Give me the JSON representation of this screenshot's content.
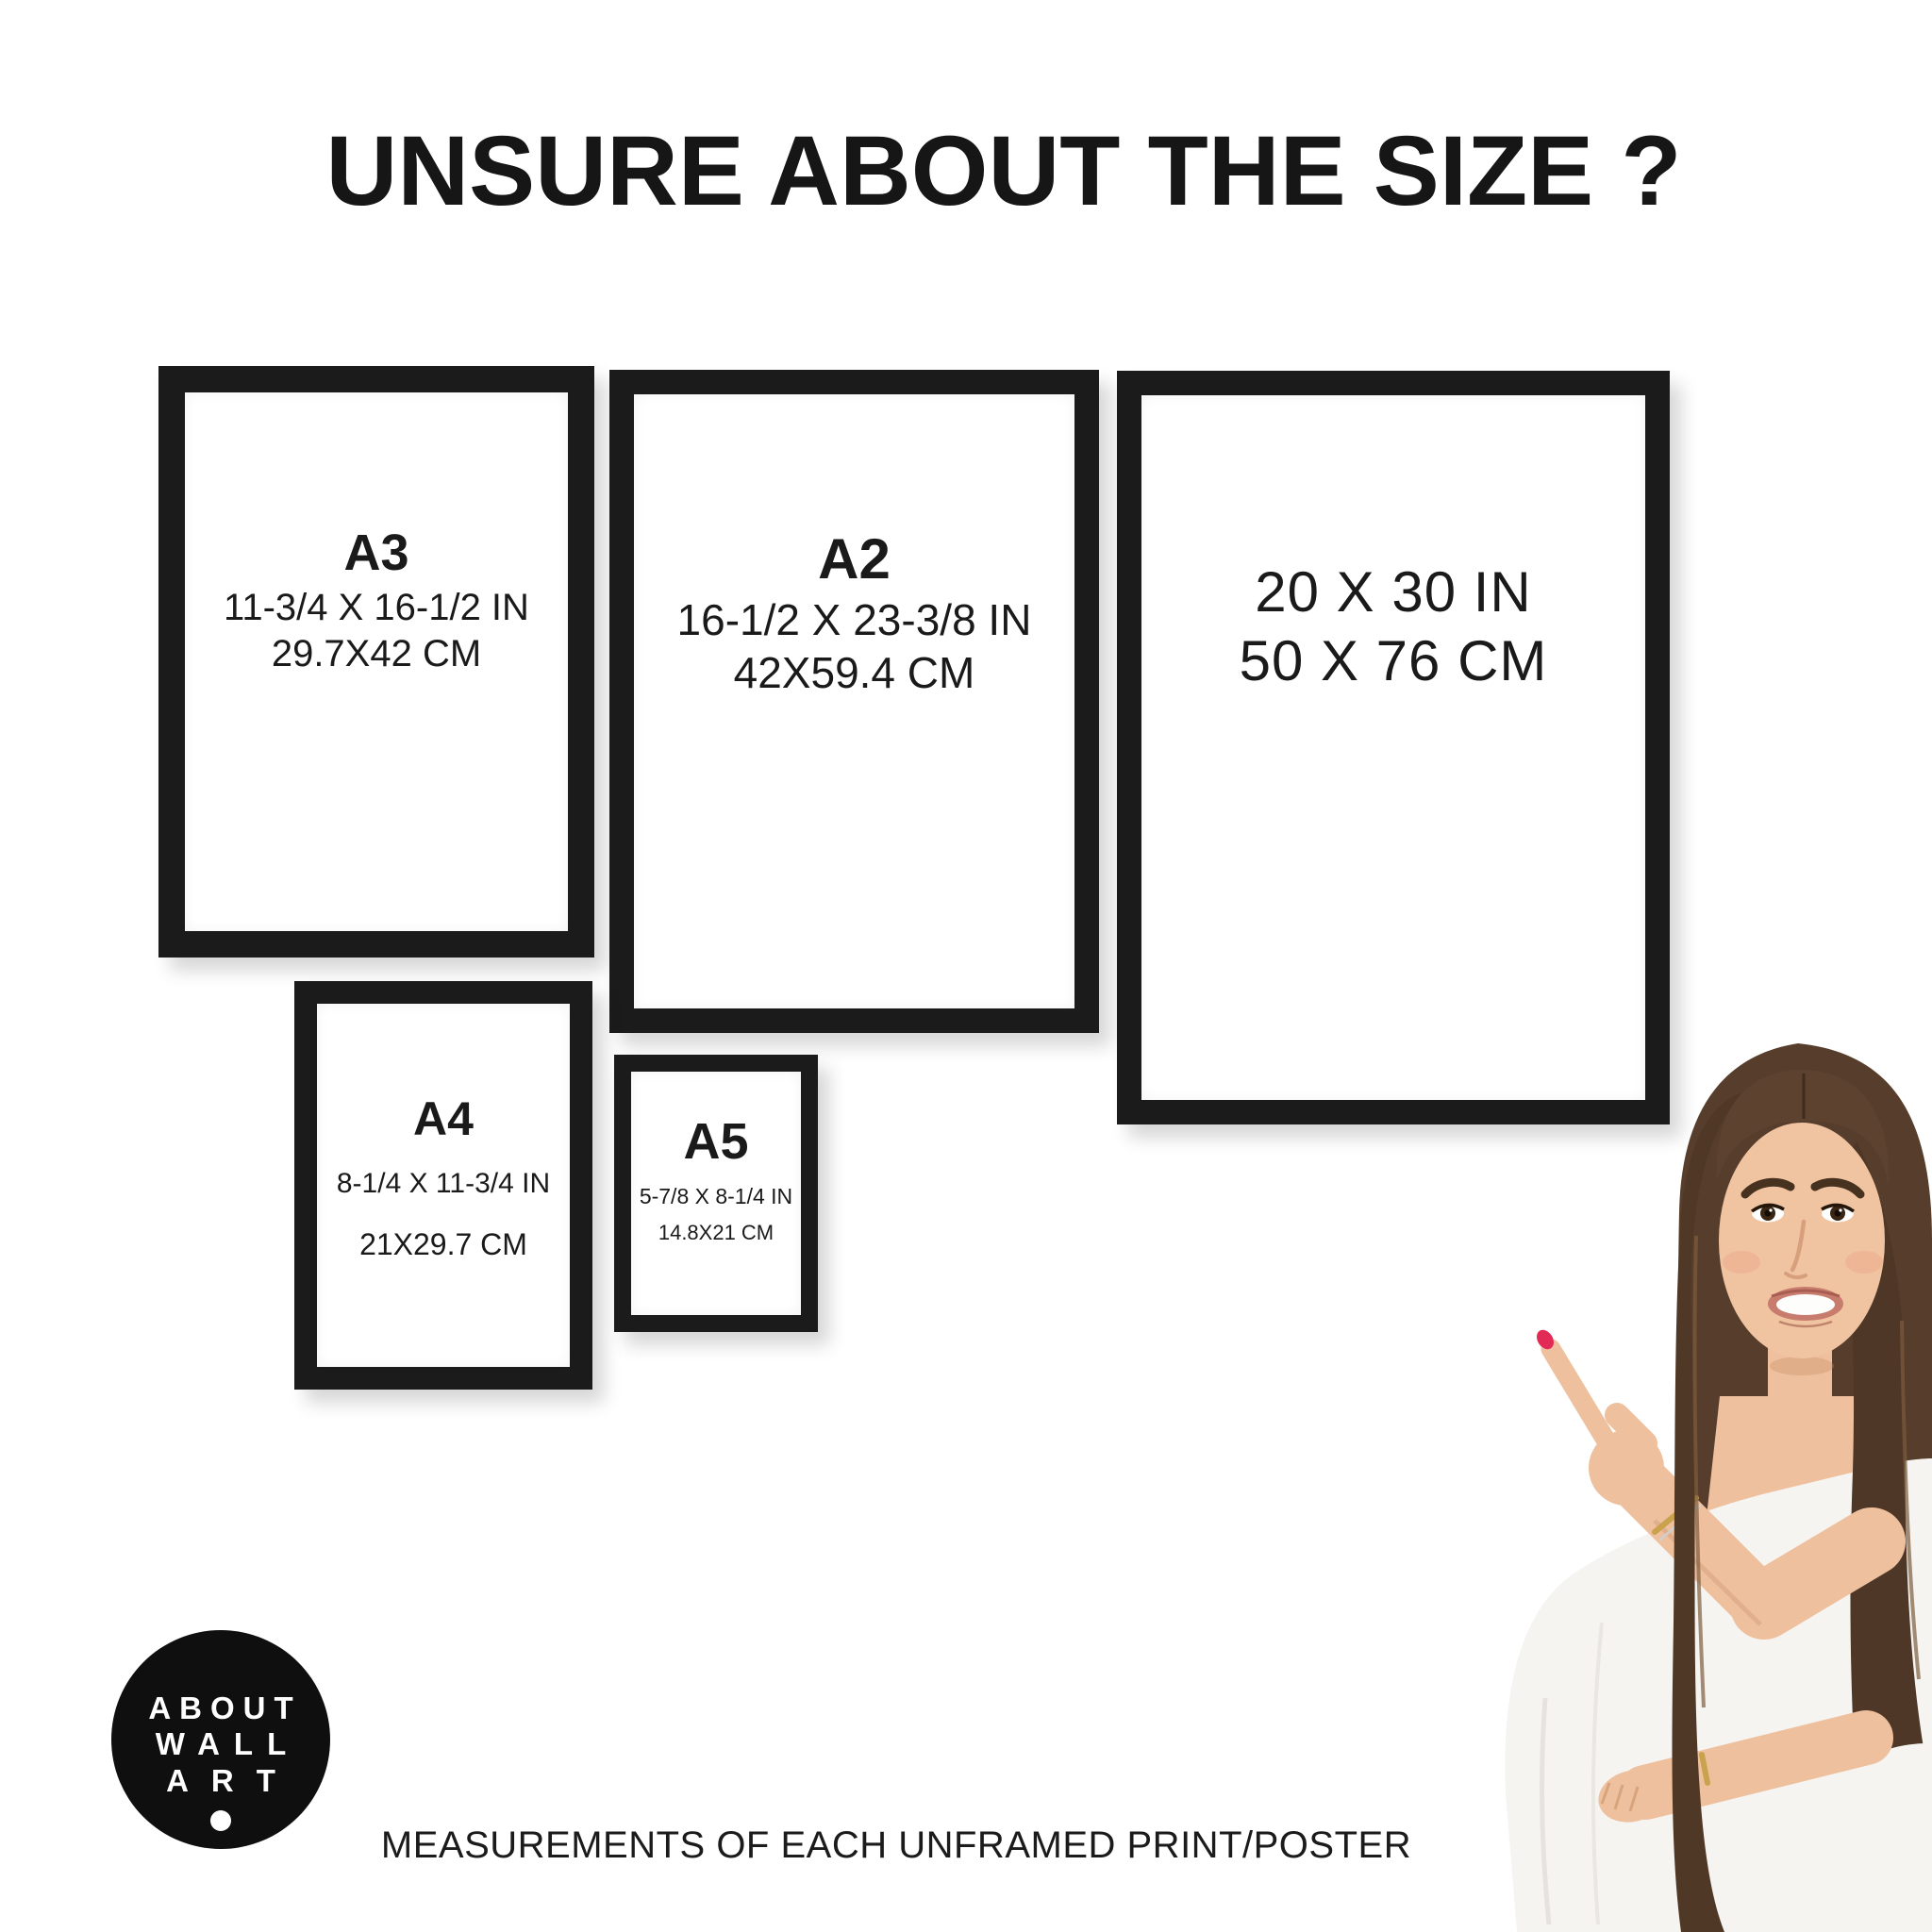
{
  "title": "UNSURE ABOUT THE SIZE ?",
  "frames": {
    "a3": {
      "name": "A3",
      "inches": "11-3/4 X 16-1/2 IN",
      "cm": "29.7X42 CM"
    },
    "a2": {
      "name": "A2",
      "inches": "16-1/2 X 23-3/8 IN",
      "cm": "42X59.4 CM"
    },
    "poster20x30": {
      "inches": "20 X 30 IN",
      "cm": "50 X 76 CM"
    },
    "a4": {
      "name": "A4",
      "inches": "8-1/4 X 11-3/4 IN",
      "cm": "21X29.7 CM"
    },
    "a5": {
      "name": "A5",
      "inches": "5-7/8 X 8-1/4 IN",
      "cm": "14.8X21 CM"
    }
  },
  "logo": {
    "line1": "ABOUT",
    "line2": "WALL",
    "line3": "ART"
  },
  "caption": "MEASUREMENTS OF EACH UNFRAMED PRINT/POSTER",
  "colors": {
    "frame": "#1b1b1b",
    "text": "#1a1a1a",
    "logo_bg": "#0f0f0f",
    "logo_text": "#ffffff",
    "nail_polish": "#e12a55",
    "skin": "#eec09e",
    "hair": "#573d2b",
    "blouse": "#f6f4f1",
    "background": "#ffffff"
  }
}
